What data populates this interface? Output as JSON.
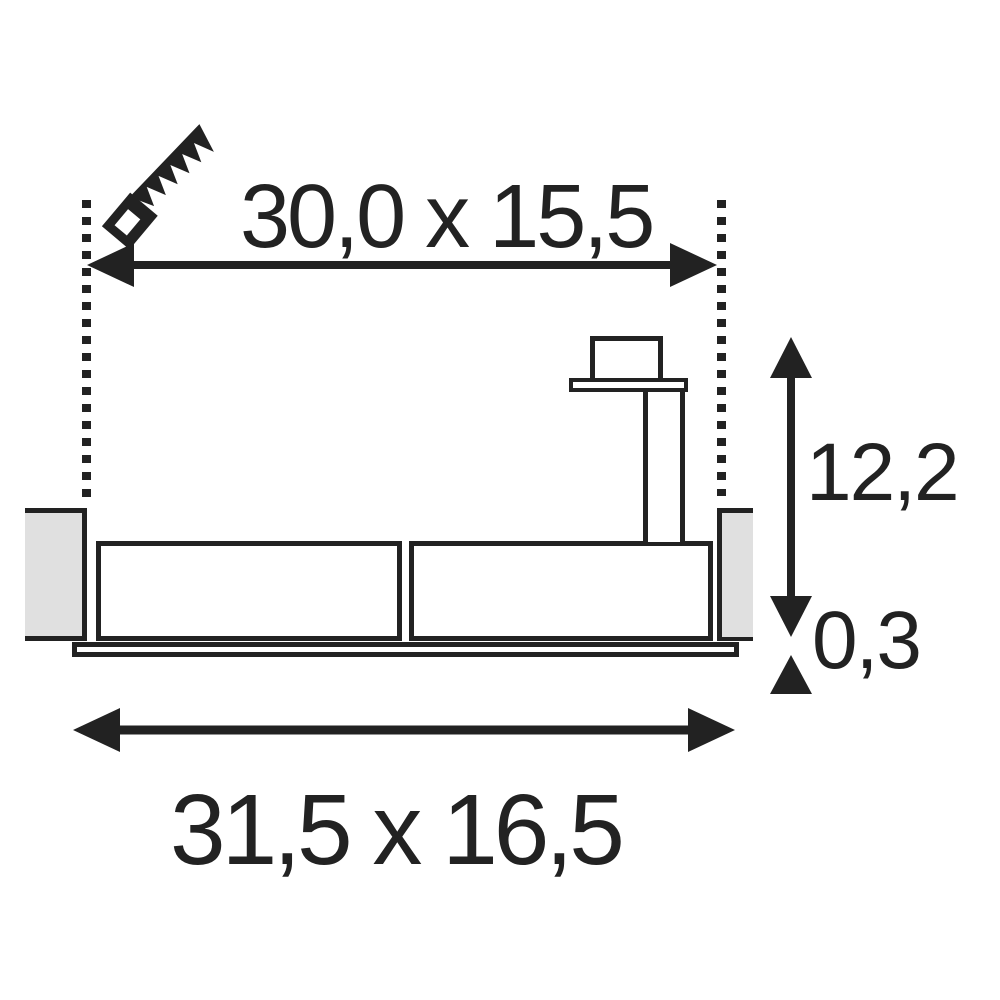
{
  "drawing": {
    "title": "recessed-luminaire-installation-dimensions",
    "labels": {
      "cutout": "30,0 x 15,5",
      "depth": "12,2",
      "trim": "0,3",
      "overall": "31,5 x 16,5"
    },
    "icons": {
      "saw": "saw-icon"
    },
    "colors": {
      "ink": "#222222",
      "ceiling": "#e0e0e0",
      "bg": "#ffffff"
    }
  }
}
